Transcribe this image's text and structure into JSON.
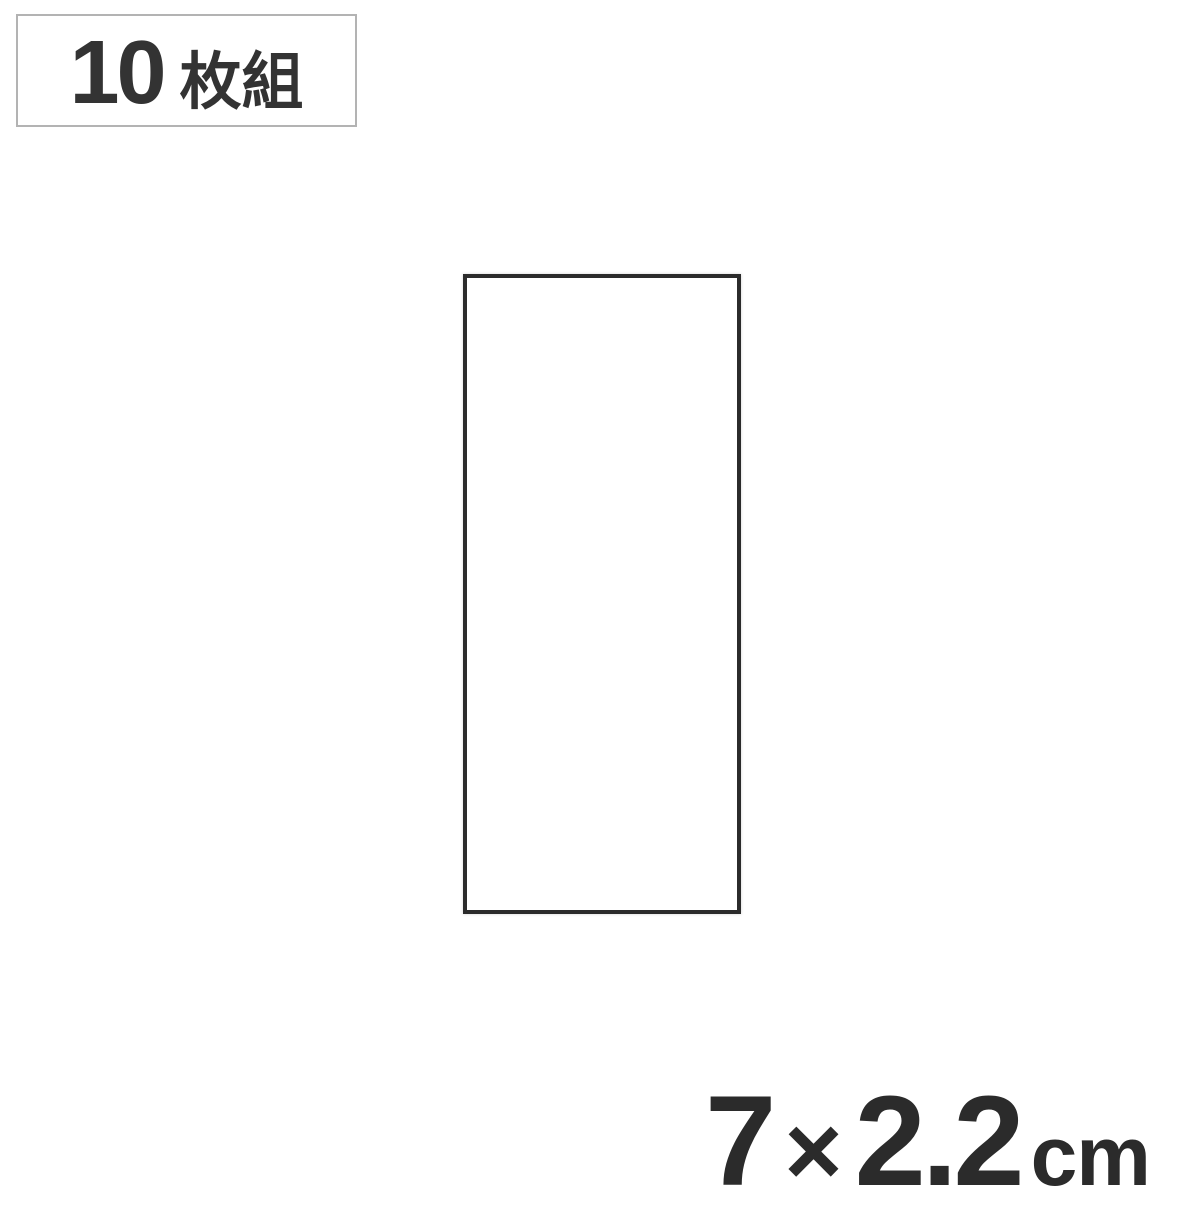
{
  "badge": {
    "quantity": "10",
    "unit": "枚組"
  },
  "size_annotation": {
    "width_value": "7",
    "multiply_sign": "×",
    "height_value": "2.2",
    "unit": "cm"
  },
  "colors": {
    "background": "#ffffff",
    "badge_border": "#b3b3b3",
    "badge_text": "#333333",
    "rectangle_border": "#2b2b2b",
    "dimension_text": "#2b2b2b"
  }
}
